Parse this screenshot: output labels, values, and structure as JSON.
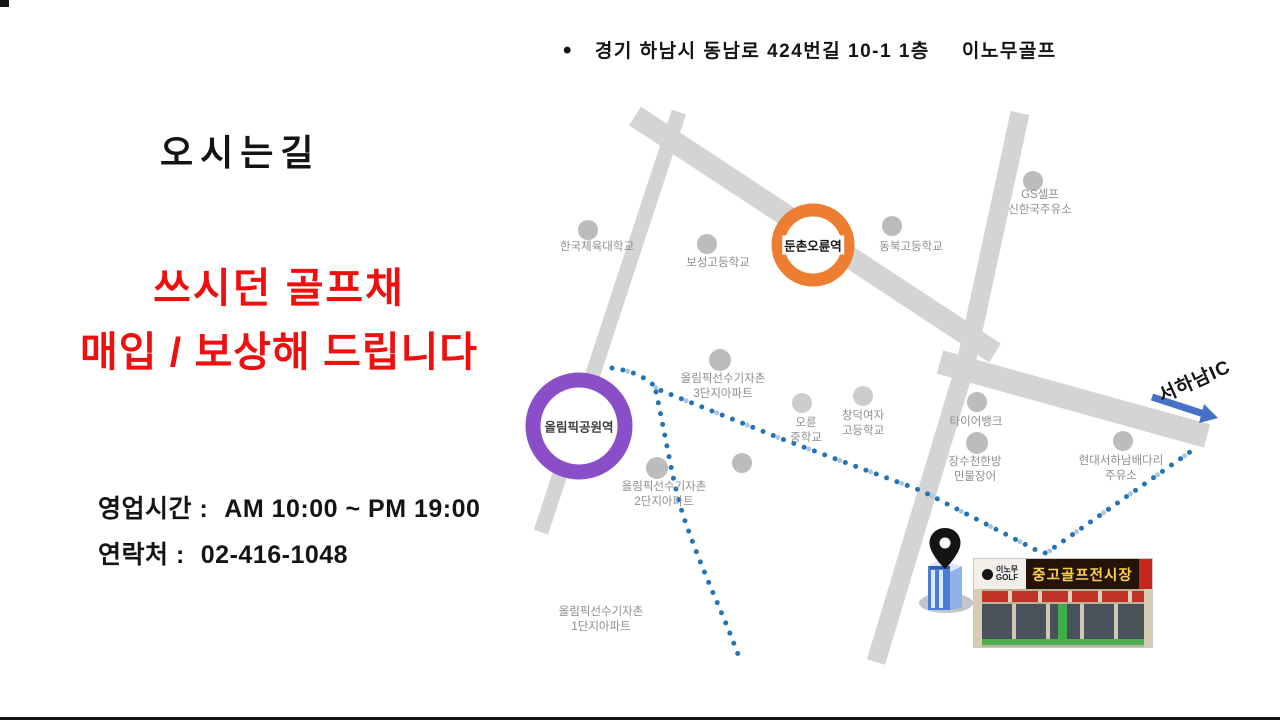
{
  "header": {
    "bullet": "•",
    "address": "경기 하남시 동남로 424번길 10-1 1층",
    "brand": "이노무골프"
  },
  "left_panel": {
    "title": "오시는길",
    "promo_line1": "쓰시던 골프채",
    "promo_line2": "매입 / 보상해 드립니다",
    "promo_color": "#ee0f0f",
    "hours_label": "영업시간 :",
    "hours_value": "AM 10:00 ~ PM 19:00",
    "contact_label": "연락처 :",
    "contact_value": "02-416-1048"
  },
  "map": {
    "stations": [
      {
        "name": "둔촌오륜역",
        "color": "#ED7D31"
      },
      {
        "name": "올림픽공원역",
        "color": "#8a4fc8"
      }
    ],
    "labels": [
      {
        "text": "한국체육대학교"
      },
      {
        "text": "보성고등학교"
      },
      {
        "text": "동북고등학교"
      },
      {
        "text": "GS셀프\n신한국주유소"
      },
      {
        "text": "올림픽선수기자촌\n3단지아파트"
      },
      {
        "text": "오륜\n중학교"
      },
      {
        "text": "창덕여자\n고등학교"
      },
      {
        "text": "타이어뱅크"
      },
      {
        "text": "장수천한방\n민물장어"
      },
      {
        "text": "현대서하남배다리\n주유소"
      },
      {
        "text": "올림픽선수기자촌\n2단지아파트"
      },
      {
        "text": "올림픽선수기자촌\n1단지아파트"
      }
    ],
    "ic_label": "서하남IC",
    "colors": {
      "road": "#d4d4d4",
      "route_dot": "#2273b8",
      "route_dot_light": "#a9c6e2",
      "poi_dot": "#bcbcbc",
      "poi_dot_light": "#cdcdcd",
      "arrow": "#4472C4",
      "pin": "#141414"
    }
  },
  "store": {
    "sign_left_line1": "이노무",
    "sign_left_line2": "GOLF",
    "sign_main": "중고골프전시장"
  }
}
